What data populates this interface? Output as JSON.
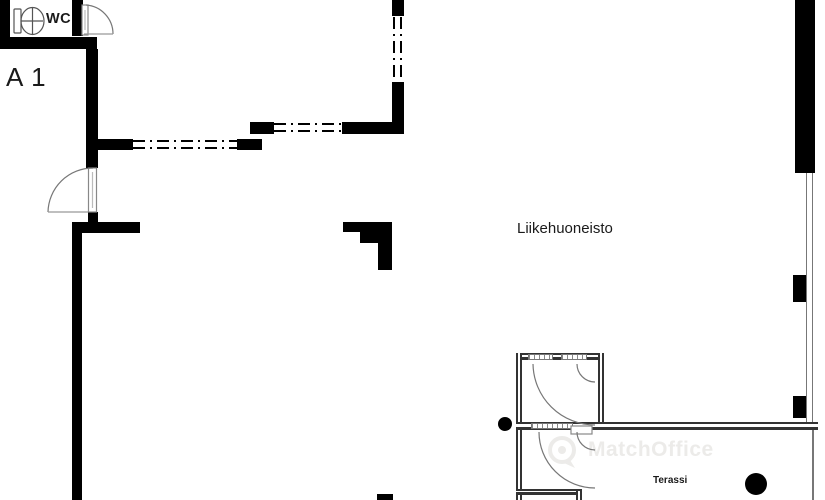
{
  "plan": {
    "unit_label": "A 1",
    "wc_label": "WC",
    "room_label": "Liikehuoneisto",
    "terrace_label": "Terassi",
    "watermark": "MatchOffice",
    "colors": {
      "wall": "#000000",
      "frame": "#333333",
      "thin": "#777777",
      "text": "#1a1a1a",
      "watermark": "#ecebe9"
    }
  }
}
